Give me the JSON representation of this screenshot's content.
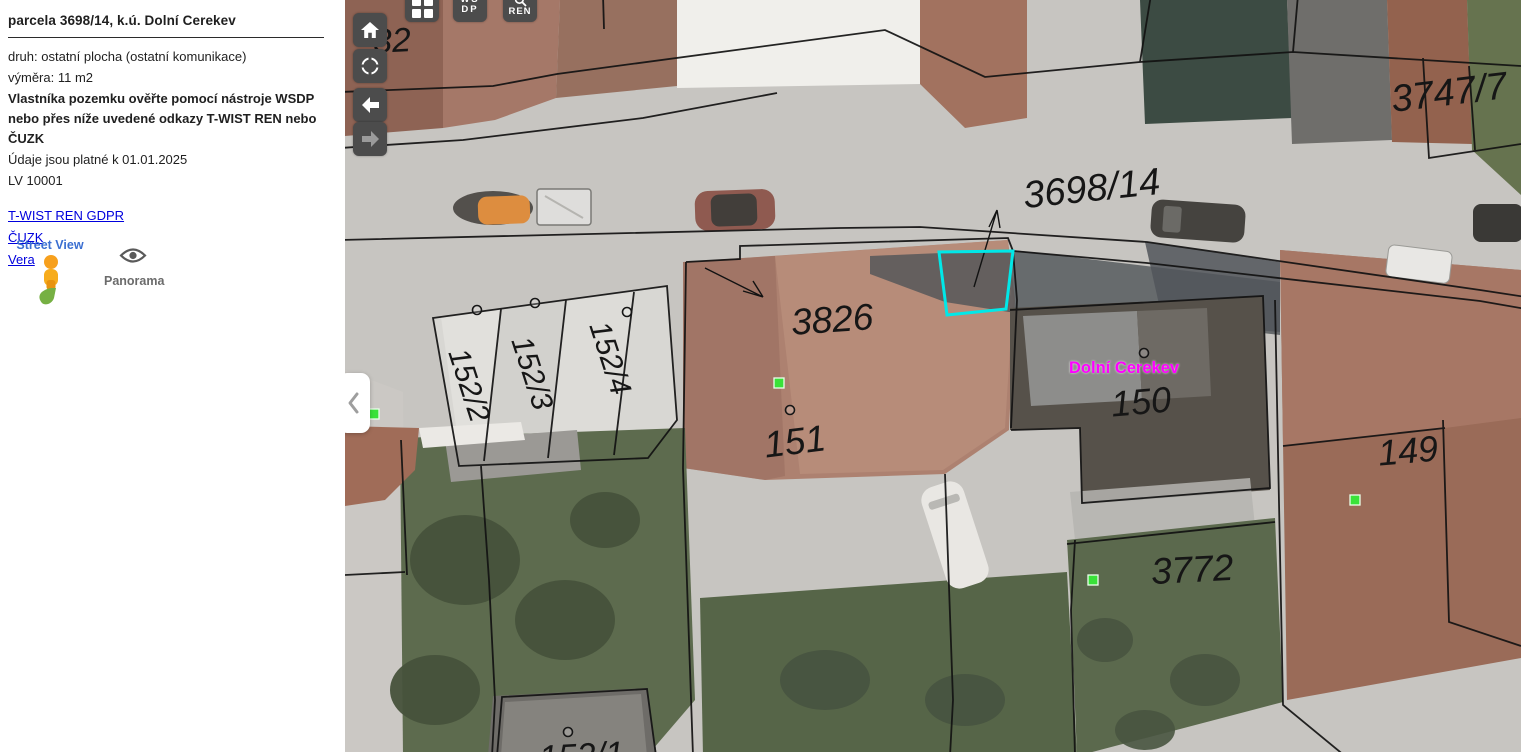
{
  "sidebar": {
    "title": "parcela 3698/14, k.ú. Dolní Cerekev",
    "info": {
      "druh": "druh: ostatní plocha (ostatní komunikace)",
      "vymera": "výměra: 11 m2",
      "owner_note": "Vlastníka pozemku ověřte pomocí nástroje WSDP nebo přes níže uvedené odkazy T-WIST REN nebo ČUZK",
      "validity": "Údaje jsou platné k 01.01.2025",
      "lv": "LV 10001"
    },
    "links": [
      {
        "label": "T-WIST REN GDPR"
      },
      {
        "label": "ČUZK"
      },
      {
        "label": "Vera"
      }
    ],
    "street_view": {
      "label": "Street View"
    },
    "panorama": {
      "label": "Panorama"
    }
  },
  "toolbar": {
    "wsdp_line1": "WS",
    "wsdp_line2": "DP",
    "ren_label": "REN"
  },
  "map": {
    "highlighted_parcel": "3698/14",
    "colors": {
      "highlight_outline": "#00e8e8",
      "town_label": "#ff00ff",
      "building_marker": "#39e239",
      "parcel_label": "#161616"
    },
    "town_label": {
      "text": "Dolní Cerekev"
    },
    "parcel_labels": [
      {
        "text": "32"
      },
      {
        "text": "3747/7"
      },
      {
        "text": "3698/14"
      },
      {
        "text": "3826"
      },
      {
        "text": "152/2"
      },
      {
        "text": "152/3"
      },
      {
        "text": "152/4"
      },
      {
        "text": "151"
      },
      {
        "text": "150"
      },
      {
        "text": "149"
      },
      {
        "text": "3772"
      },
      {
        "text": "152/1"
      }
    ]
  }
}
